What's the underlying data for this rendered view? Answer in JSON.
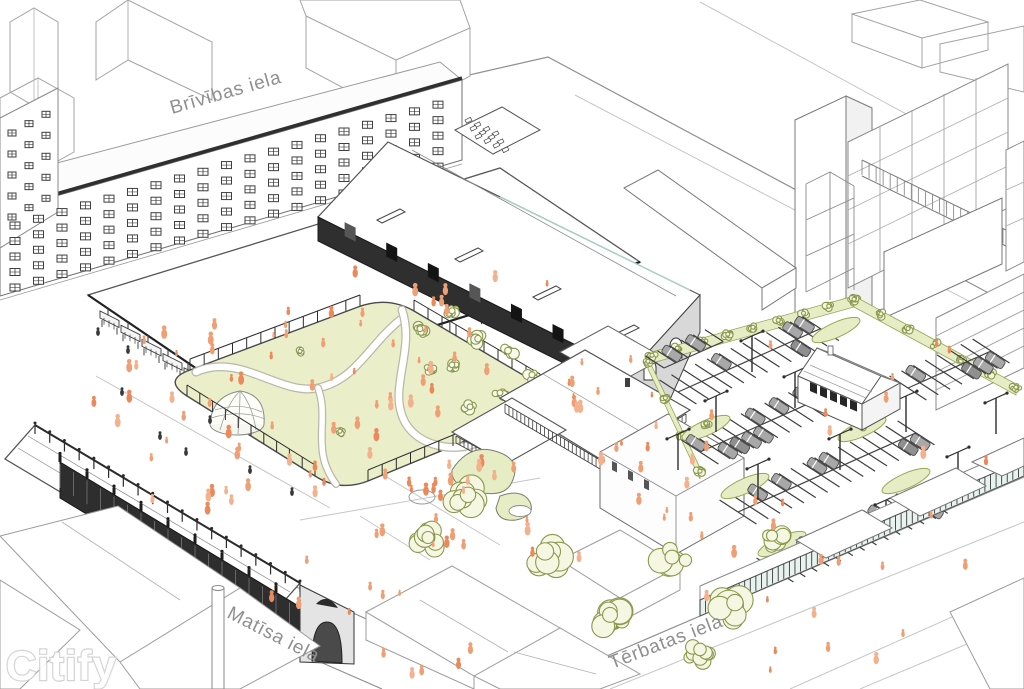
{
  "scene": {
    "watermark": "Citify",
    "streets": [
      {
        "id": "brivibas",
        "name": "Brīvības iela"
      },
      {
        "id": "matisa",
        "name": "Matīsa iela"
      },
      {
        "id": "terbatas",
        "name": "Tērbatas iela"
      }
    ],
    "colors": {
      "background": "#ffffff",
      "ink": "#3a3a3a",
      "line_medium": "#8f8f8f",
      "line_light": "#c6c6c6",
      "park_fill": "#eaeec9",
      "planting_fill": "#e6ecc3",
      "tree_fill": "#fafbef",
      "tree_stroke": "#8a994d",
      "foliage": "#6e803c",
      "people": "#f09f74",
      "people_alt": "#ea8a5c",
      "car": "#a8a8a8",
      "dark_wall": "#2e2e2e",
      "gray_wall": "#d8d8d8",
      "glazing": "#e8f2ee",
      "label_text": "#8f8f8f",
      "watermark_outline": "#d2d2d2"
    }
  }
}
